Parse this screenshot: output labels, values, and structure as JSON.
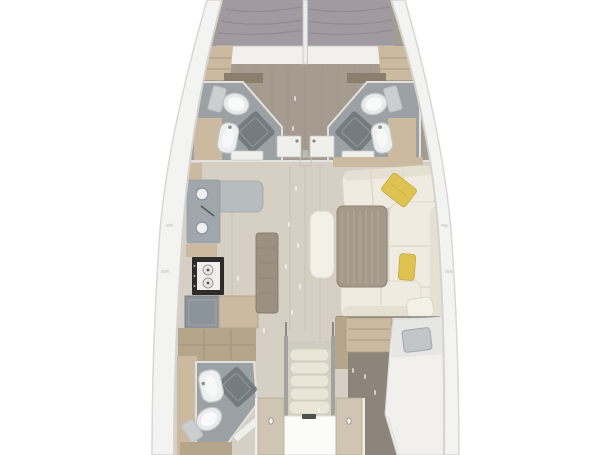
{
  "diagram": {
    "type": "sailboat-interior-floor-plan",
    "view": "top-down",
    "areas": [
      "forward-berth-port",
      "forward-berth-starboard",
      "forward-head-port",
      "forward-head-starboard",
      "galley",
      "saloon",
      "companionway",
      "aft-head-port",
      "aft-cabin-starboard"
    ]
  },
  "colors": {
    "background": "#ffffff",
    "hull_rim": "#f3f3f1",
    "rim_tick": "#dcdcd9",
    "floor_forward": "#a59b8f",
    "floor_salon": "#d6cfc3",
    "floor_aft": "#8e857a",
    "floor_bath": "#9ba1a4",
    "shower_mat": "#757c80",
    "mattress": "#a19aa1",
    "bed_foot": "#f1f0ec",
    "berth_head": "#e6e7e5",
    "wood_light": "#cbbaa0",
    "wood_mid": "#b4a58b",
    "wood_dark": "#8c7e6c",
    "island_wood": "#9a9181",
    "table_wood": "#a4998b",
    "sofa": "#efebe0",
    "sofa_back": "#e5e0d1",
    "cushion": "#f2f0e7",
    "pillow_yellow": "#dec353",
    "pillow_gray": "#c2c6c7",
    "counter_light": "#b7bcbf",
    "counter_mid": "#9fa7ac",
    "locker": "#8b949b",
    "stove": "#2d2c2a",
    "stove_top": "#f0efec",
    "burner": "#e6e6e3",
    "fixture": "#eef0ef",
    "porcelain": "#e9ebea",
    "tank": "#cbcfd0",
    "door_white": "#efefec",
    "door_wood": "#cfc5b2",
    "door_jamb": "#eeedea",
    "handle": "#8a8a86",
    "hatch": "#e6e5e2",
    "post": "#b9b8b4",
    "rail": "#a3a39d",
    "step": "#e9e5d7",
    "step_top": "#cfccc0",
    "platform": "#fbfbfa",
    "latch": "#4f4f4c",
    "white": "#ffffff"
  }
}
